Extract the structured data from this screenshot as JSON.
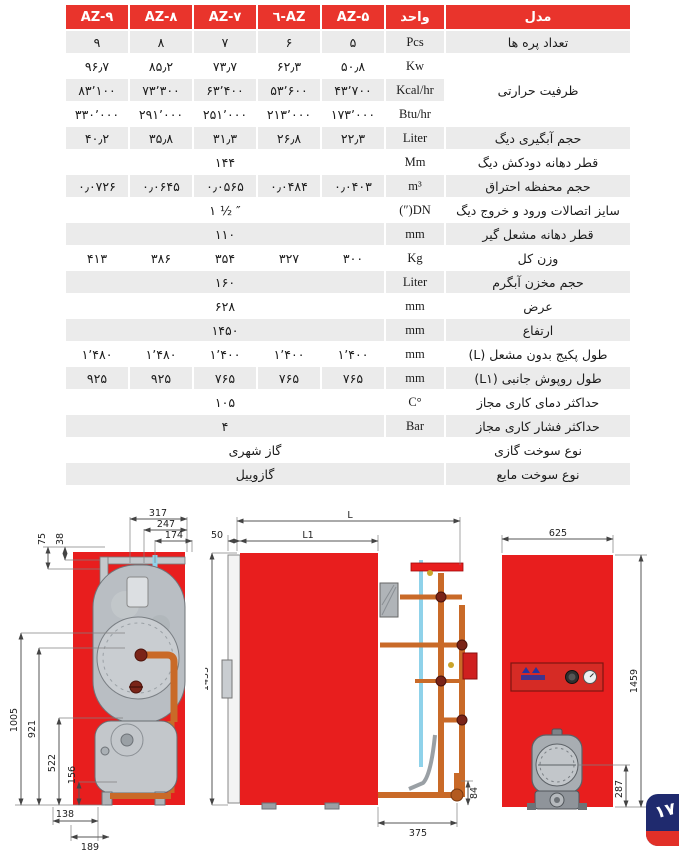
{
  "table": {
    "header": {
      "model": "مدل",
      "unit": "واحد",
      "az5": "AZ-۵",
      "az6": "AZ-٦",
      "az7": "AZ-۷",
      "az8": "AZ-۸",
      "az9": "AZ-۹"
    },
    "rows": {
      "fins": {
        "label": "تعداد پره ها",
        "unit": "Pcs",
        "values": [
          "۹",
          "۸",
          "۷",
          "۶",
          "۵"
        ]
      },
      "capacity_label": "ظرفیت حرارتی",
      "kw": {
        "unit": "Kw",
        "values": [
          "۹۶٫۷",
          "۸۵٫۲",
          "۷۳٫۷",
          "۶۲٫۳",
          "۵۰٫۸"
        ]
      },
      "kcal": {
        "unit": "Kcal/hr",
        "values": [
          "۸۳٬۱۰۰",
          "۷۳٬۳۰۰",
          "۶۳٬۴۰۰",
          "۵۳٬۶۰۰",
          "۴۳٬۷۰۰"
        ]
      },
      "btu": {
        "unit": "Btu/hr",
        "values": [
          "۳۳۰٬۰۰۰",
          "۲۹۱٬۰۰۰",
          "۲۵۱٬۰۰۰",
          "۲۱۳٬۰۰۰",
          "۱۷۳٬۰۰۰"
        ]
      },
      "water_volume": {
        "label": "حجم آبگیری دیگ",
        "unit": "Liter",
        "values": [
          "۴۰٫۲",
          "۳۵٫۸",
          "۳۱٫۳",
          "۲۶٫۸",
          "۲۲٫۳"
        ]
      },
      "chimney": {
        "label": "قطر دهانه دودکش دیگ",
        "unit": "Mm",
        "value": "۱۴۴"
      },
      "chamber": {
        "label": "حجم محفظه احتراق",
        "unit": "m³",
        "values": [
          "۰٫۰۷۲۶",
          "۰٫۰۶۴۵",
          "۰٫۰۵۶۵",
          "۰٫۰۴۸۴",
          "۰٫۰۴۰۳"
        ]
      },
      "connections": {
        "label": "سایز اتصالات ورود و خروج دیگ",
        "unit": "DN(″)",
        "value": "۱ ½ ″"
      },
      "burner_mount": {
        "label": "قطر دهانه مشعل گیر",
        "unit": "mm",
        "value": "۱۱۰"
      },
      "weight": {
        "label": "وزن کل",
        "unit": "Kg",
        "values": [
          "۴۱۳",
          "۳۸۶",
          "۳۵۴",
          "۳۲۷",
          "۳۰۰"
        ]
      },
      "tank_volume": {
        "label": "حجم مخزن آبگرم",
        "unit": "Liter",
        "value": "۱۶۰"
      },
      "width": {
        "label": "عرض",
        "unit": "mm",
        "value": "۶۲۸"
      },
      "height": {
        "label": "ارتفاع",
        "unit": "mm",
        "value": "۱۴۵۰"
      },
      "length_l": {
        "label": "طول پکیج بدون مشعل (L)",
        "unit": "mm",
        "values": [
          "۱٬۴۸۰",
          "۱٬۴۸۰",
          "۱٬۴۰۰",
          "۱٬۴۰۰",
          "۱٬۴۰۰"
        ]
      },
      "length_l1": {
        "label": "طول روپوش جانبی (L۱)",
        "unit": "mm",
        "values": [
          "۹۲۵",
          "۹۲۵",
          "۷۶۵",
          "۷۶۵",
          "۷۶۵"
        ]
      },
      "max_temp": {
        "label": "حداکثر دمای کاری مجاز",
        "unit": "°C",
        "value": "۱۰۵"
      },
      "max_pressure": {
        "label": "حداکثر فشار کاری مجاز",
        "unit": "Bar",
        "value": "۴"
      },
      "gas_fuel": {
        "label": "نوع سوخت گازی",
        "value": "گاز شهری"
      },
      "liquid_fuel": {
        "label": "نوع سوخت مایع",
        "value": "گازوییل"
      }
    }
  },
  "drawings": {
    "front_section": {
      "dims": {
        "d317": "317",
        "d247": "247",
        "d174": "174",
        "d75": "75",
        "d38": "38",
        "d1005": "1005",
        "d921": "921",
        "d522": "522",
        "d156": "156",
        "d138": "138",
        "d189": "189"
      }
    },
    "side_view": {
      "dims": {
        "dL": "L",
        "dL1": "L1",
        "d50": "50",
        "d1433": "1433",
        "d375": "375",
        "d84": "84"
      }
    },
    "front_view": {
      "dims": {
        "d625": "625",
        "d1459": "1459",
        "d287": "287"
      }
    }
  },
  "page_badge": {
    "number": "۱۷"
  },
  "colors": {
    "header_red": "#e9342c",
    "drawing_red": "#e81e1e",
    "row_gray": "#ebebeb",
    "badge_navy": "#1f2a6e",
    "badge_red": "#e23028"
  }
}
